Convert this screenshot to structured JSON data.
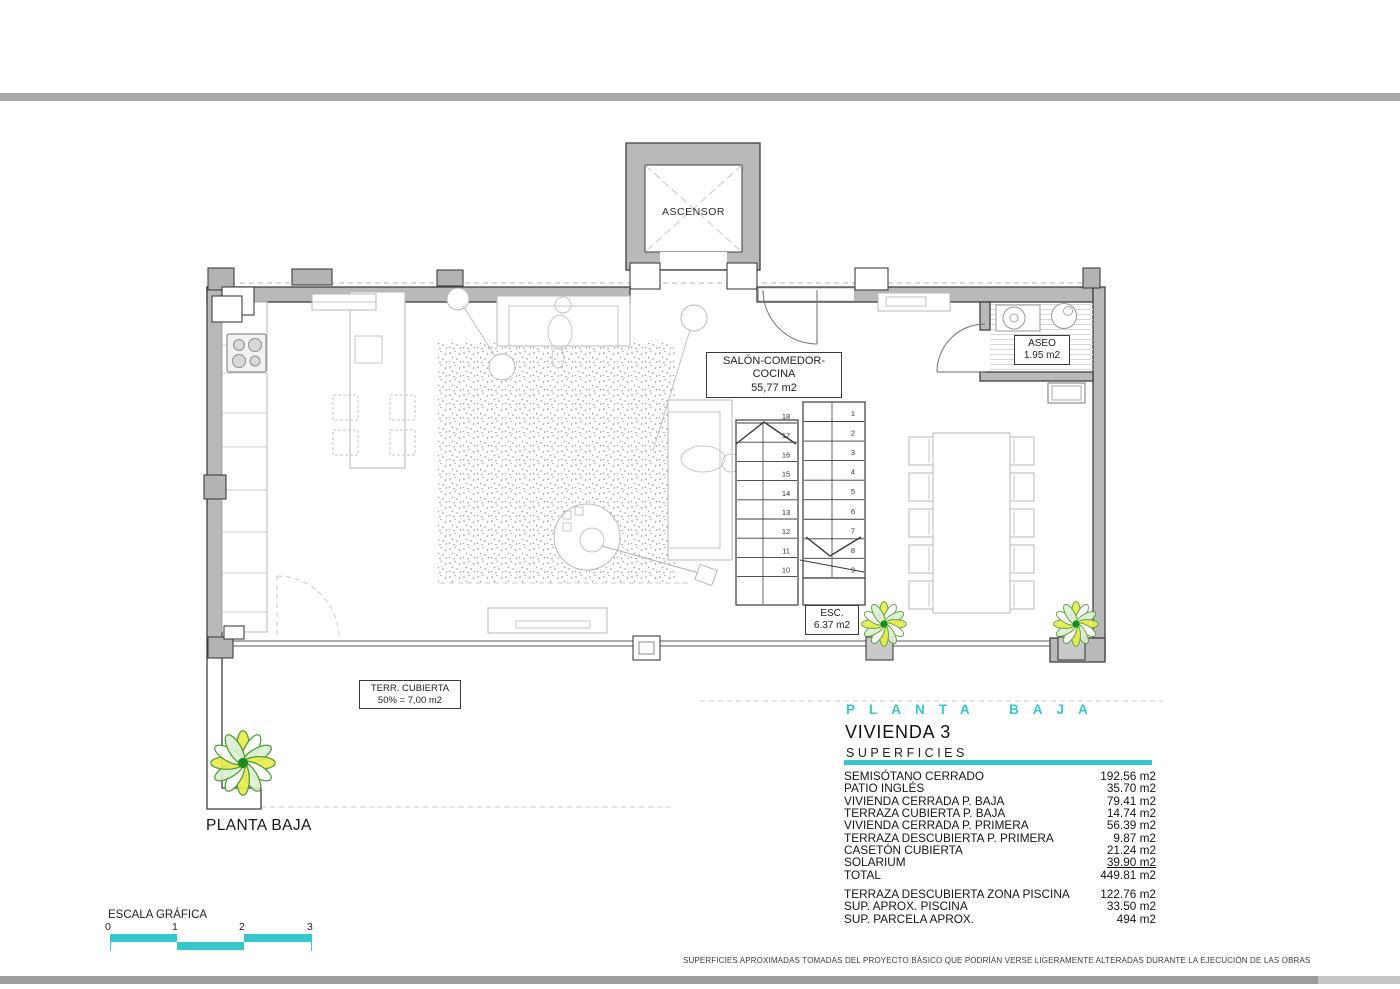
{
  "plan": {
    "ascensor_label": "ASCENSOR",
    "salon": {
      "name": "SALÓN-COMEDOR-COCINA",
      "area": "55,77 m2"
    },
    "aseo": {
      "name": "ASEO",
      "area": "1.95 m2"
    },
    "stairs_box": {
      "name": "ESC.",
      "area": "6.37 m2"
    },
    "covered_terrace": {
      "name": "TERR. CUBIERTA",
      "area": "50% = 7,00 m2"
    },
    "floor_caption": "PLANTA BAJA",
    "stairs": {
      "down_flight_numbers": [
        "18",
        "17",
        "16",
        "15",
        "14",
        "13",
        "12",
        "11",
        "10"
      ],
      "up_flight_numbers": [
        "1",
        "2",
        "3",
        "4",
        "5",
        "6",
        "7",
        "8",
        "9"
      ]
    }
  },
  "title_block": {
    "floor_heading": "PLANTA BAJA",
    "unit_heading": "VIVIENDA 3",
    "section_heading": "SUPERFICIES",
    "accent_color": "#35C7CB",
    "rows": [
      {
        "label": "SEMISÓTANO CERRADO",
        "value": "192.56 m2"
      },
      {
        "label": "PATIO INGLÉS",
        "value": "35.70 m2"
      },
      {
        "label": "VIVIENDA CERRADA P. BAJA",
        "value": "79.41 m2"
      },
      {
        "label": "TERRAZA CUBIERTA P. BAJA",
        "value": "14.74 m2"
      },
      {
        "label": "VIVIENDA CERRADA P. PRIMERA",
        "value": "56.39 m2"
      },
      {
        "label": "TERRAZA DESCUBIERTA P. PRIMERA",
        "value": "9.87 m2"
      },
      {
        "label": "CASETÓN CUBIERTA",
        "value": "21.24 m2"
      },
      {
        "label": "SOLARIUM",
        "value": "39.90 m2",
        "underline": true
      },
      {
        "label": "TOTAL",
        "value": "449.81 m2"
      }
    ],
    "extra_rows": [
      {
        "label": "TERRAZA DESCUBIERTA ZONA PISCINA",
        "value": "122.76 m2"
      },
      {
        "label": "SUP. APROX. PISCINA",
        "value": "33.50 m2"
      },
      {
        "label": "SUP. PARCELA APROX.",
        "value": "494 m2"
      }
    ]
  },
  "scale_bar": {
    "label": "ESCALA GRÁFICA",
    "ticks": [
      "0",
      "1",
      "2",
      "3"
    ]
  },
  "footer": {
    "disclaimer": "SUPERFICIES APROXIMADAS TOMADAS DEL PROYECTO BÁSICO QUE PODRÍAN VERSE LIGERAMENTE ALTERADAS DURANTE LA EJECUCIÓN DE LAS OBRAS"
  }
}
